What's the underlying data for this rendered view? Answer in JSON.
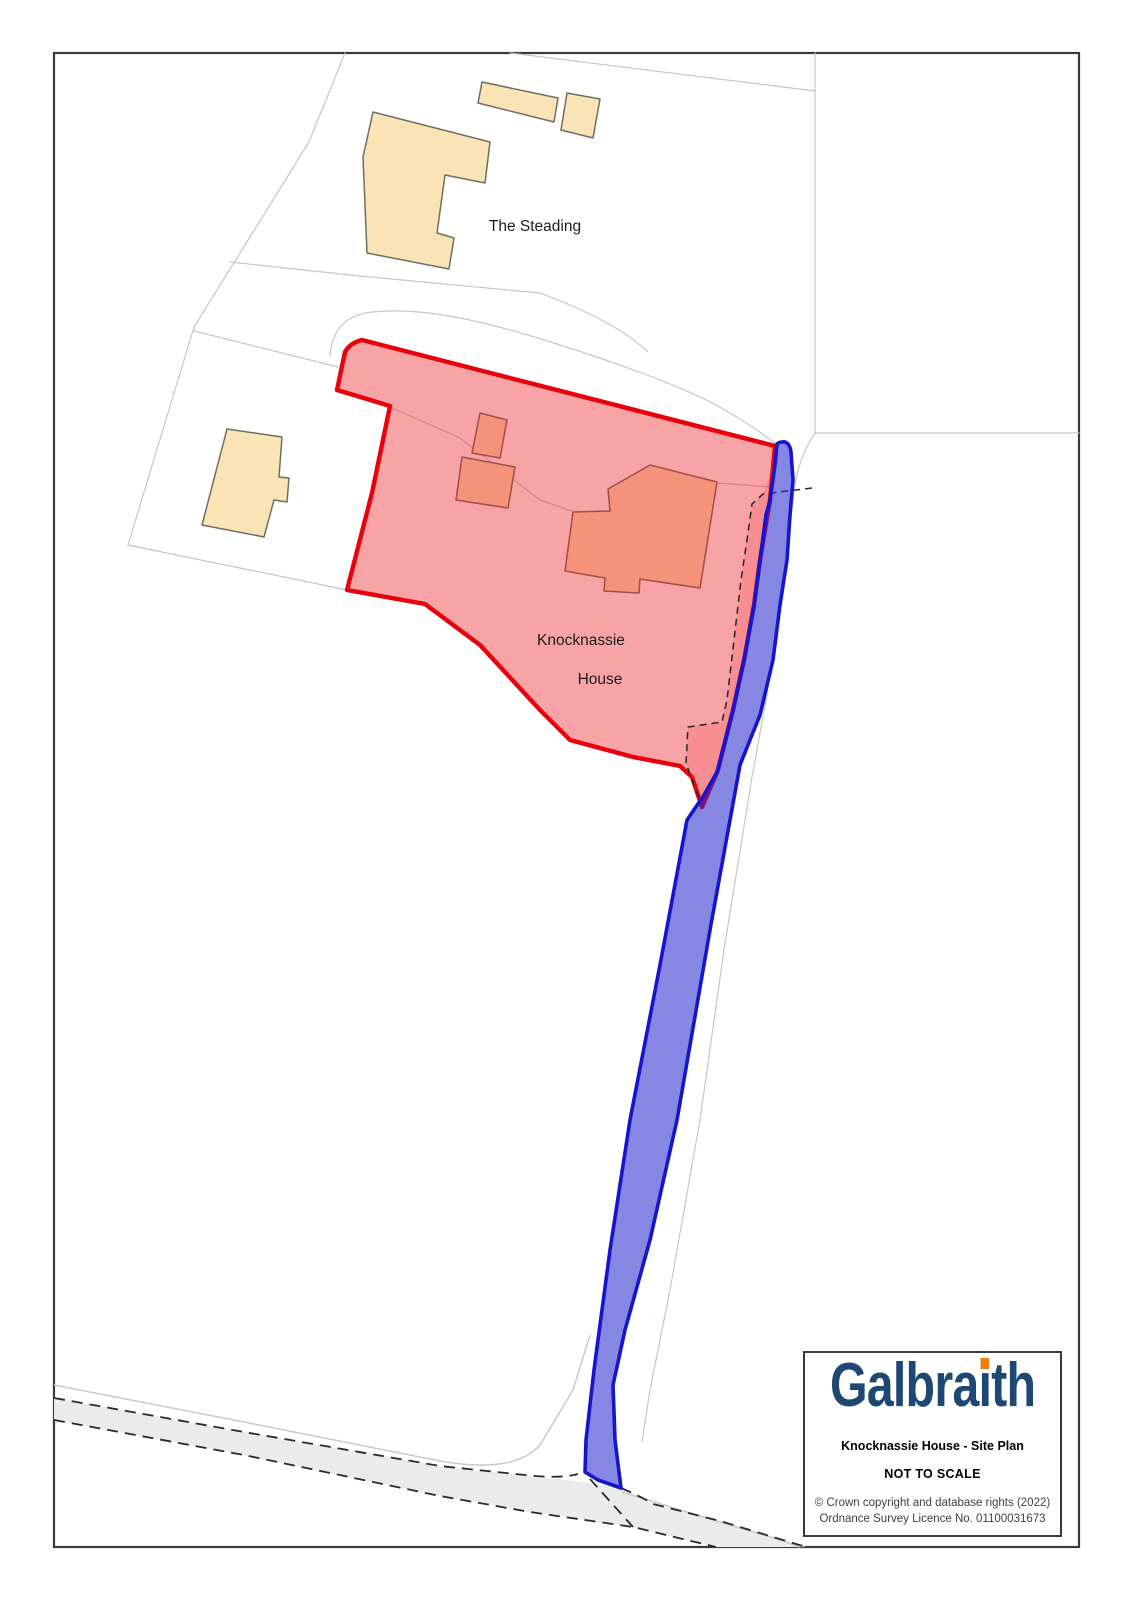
{
  "map": {
    "labels": {
      "steading": "The Steading",
      "knocknassie_line1": "Knocknassie",
      "knocknassie_line2": "House"
    },
    "colors": {
      "frame": "#3a3a3a",
      "parcel_line": "#c6c6c6",
      "road_fill": "#ebebeb",
      "road_dash": "#2a2a2a",
      "road_verge": "#c9c9c9",
      "building_fill": "#fae3b4",
      "building_stroke": "#6f6f60",
      "red_fill": "#ed1c24",
      "red_stroke": "#e8000b",
      "blue_fill": "#2222cc",
      "blue_stroke": "#1515ce",
      "inner_dash": "#262626",
      "label_text": "#1c1c1c"
    }
  },
  "info_box": {
    "logo": {
      "full_text": "Galbraith",
      "part1": "Galbra",
      "i_glyph": "ı",
      "part2": "th",
      "navy": "#1e4874",
      "orange": "#f07d12"
    },
    "title": "Knocknassie House - Site Plan",
    "scale_note": "NOT TO SCALE",
    "copyright_line1": "© Crown copyright and database rights (2022)",
    "copyright_line2": "Ordnance Survey Licence No. 01100031673"
  }
}
